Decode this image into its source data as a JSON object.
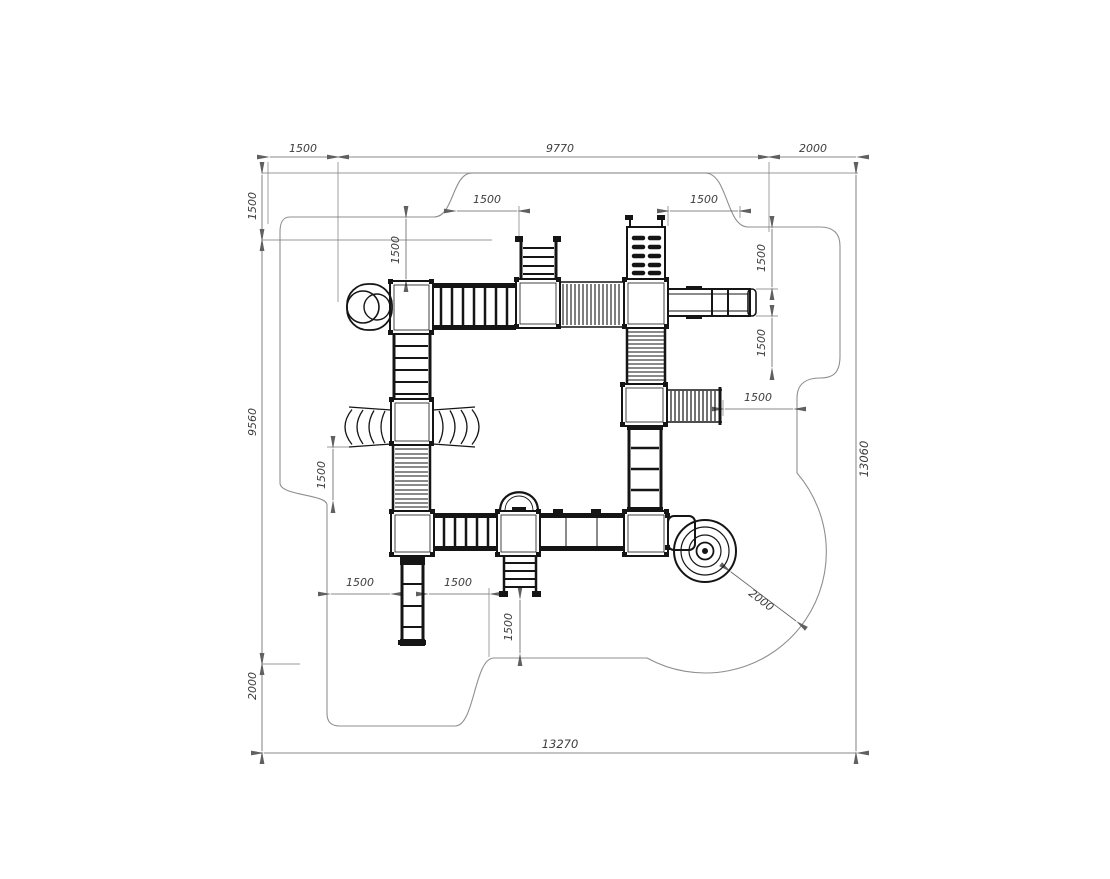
{
  "drawing": {
    "dimensions": {
      "top_chain": [
        "1500",
        "9770",
        "2000"
      ],
      "left_chain": [
        "1500",
        "9560",
        "2000"
      ],
      "right_total": "13060",
      "bottom_total": "13270",
      "inner": {
        "tower_top_clear": "1500",
        "ladder_left_clear": "1500",
        "wall_right_clear": "1500",
        "slide_upper_clear": "1500",
        "slide_lower_clear": "1500",
        "net_right_clear": "1500",
        "fan_left_clear": "1500",
        "tower_bottom_left": "1500",
        "ladder_bottom_right": "1500",
        "stairs_bottom_clear": "1500",
        "spiral_radius": "2000"
      }
    },
    "palette": {
      "equipment_line": "#151515",
      "dimension_line": "#707070",
      "boundary_line": "#8f8f8f",
      "text": "#3c3c3c",
      "background": "#ffffff"
    }
  }
}
